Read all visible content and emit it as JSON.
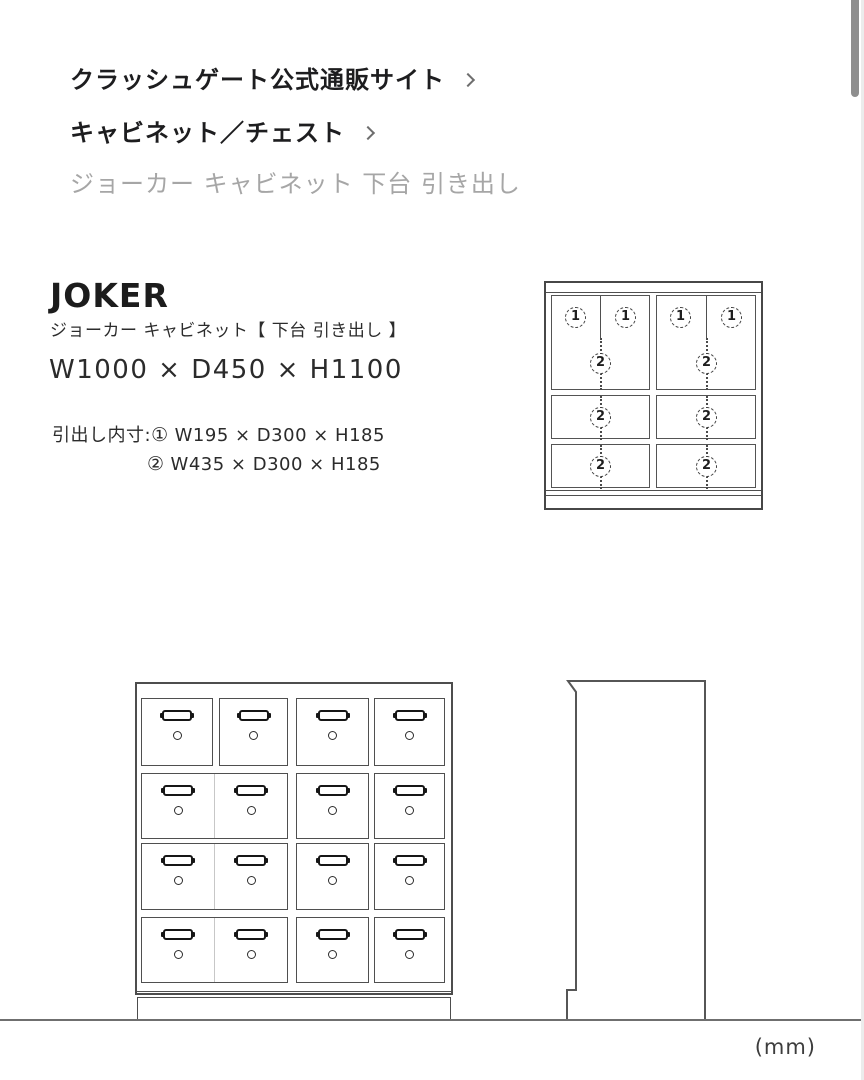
{
  "breadcrumb": {
    "items": [
      {
        "label": "クラッシュゲート公式通販サイト"
      },
      {
        "label": "キャビネット／チェスト"
      },
      {
        "label": "ジョーカー キャビネット 下台 引き出し"
      }
    ]
  },
  "product": {
    "name": "JOKER",
    "subtitle": "ジョーカー キャビネット【 下台 引き出し 】",
    "overall_size": "W1000 × D450 × H1100",
    "drawer_inner_label": "引出し内寸:",
    "drawer_specs": [
      {
        "marker": "①",
        "size": "W195 × D300 × H185"
      },
      {
        "marker": "②",
        "size": "W435 × D300 × H185"
      }
    ]
  },
  "top_view": {
    "small_markers": [
      "1",
      "1",
      "1",
      "1"
    ],
    "wide_markers": [
      "2",
      "2",
      "2",
      "2",
      "2",
      "2"
    ]
  },
  "page": {
    "unit_label": "(mm)"
  }
}
